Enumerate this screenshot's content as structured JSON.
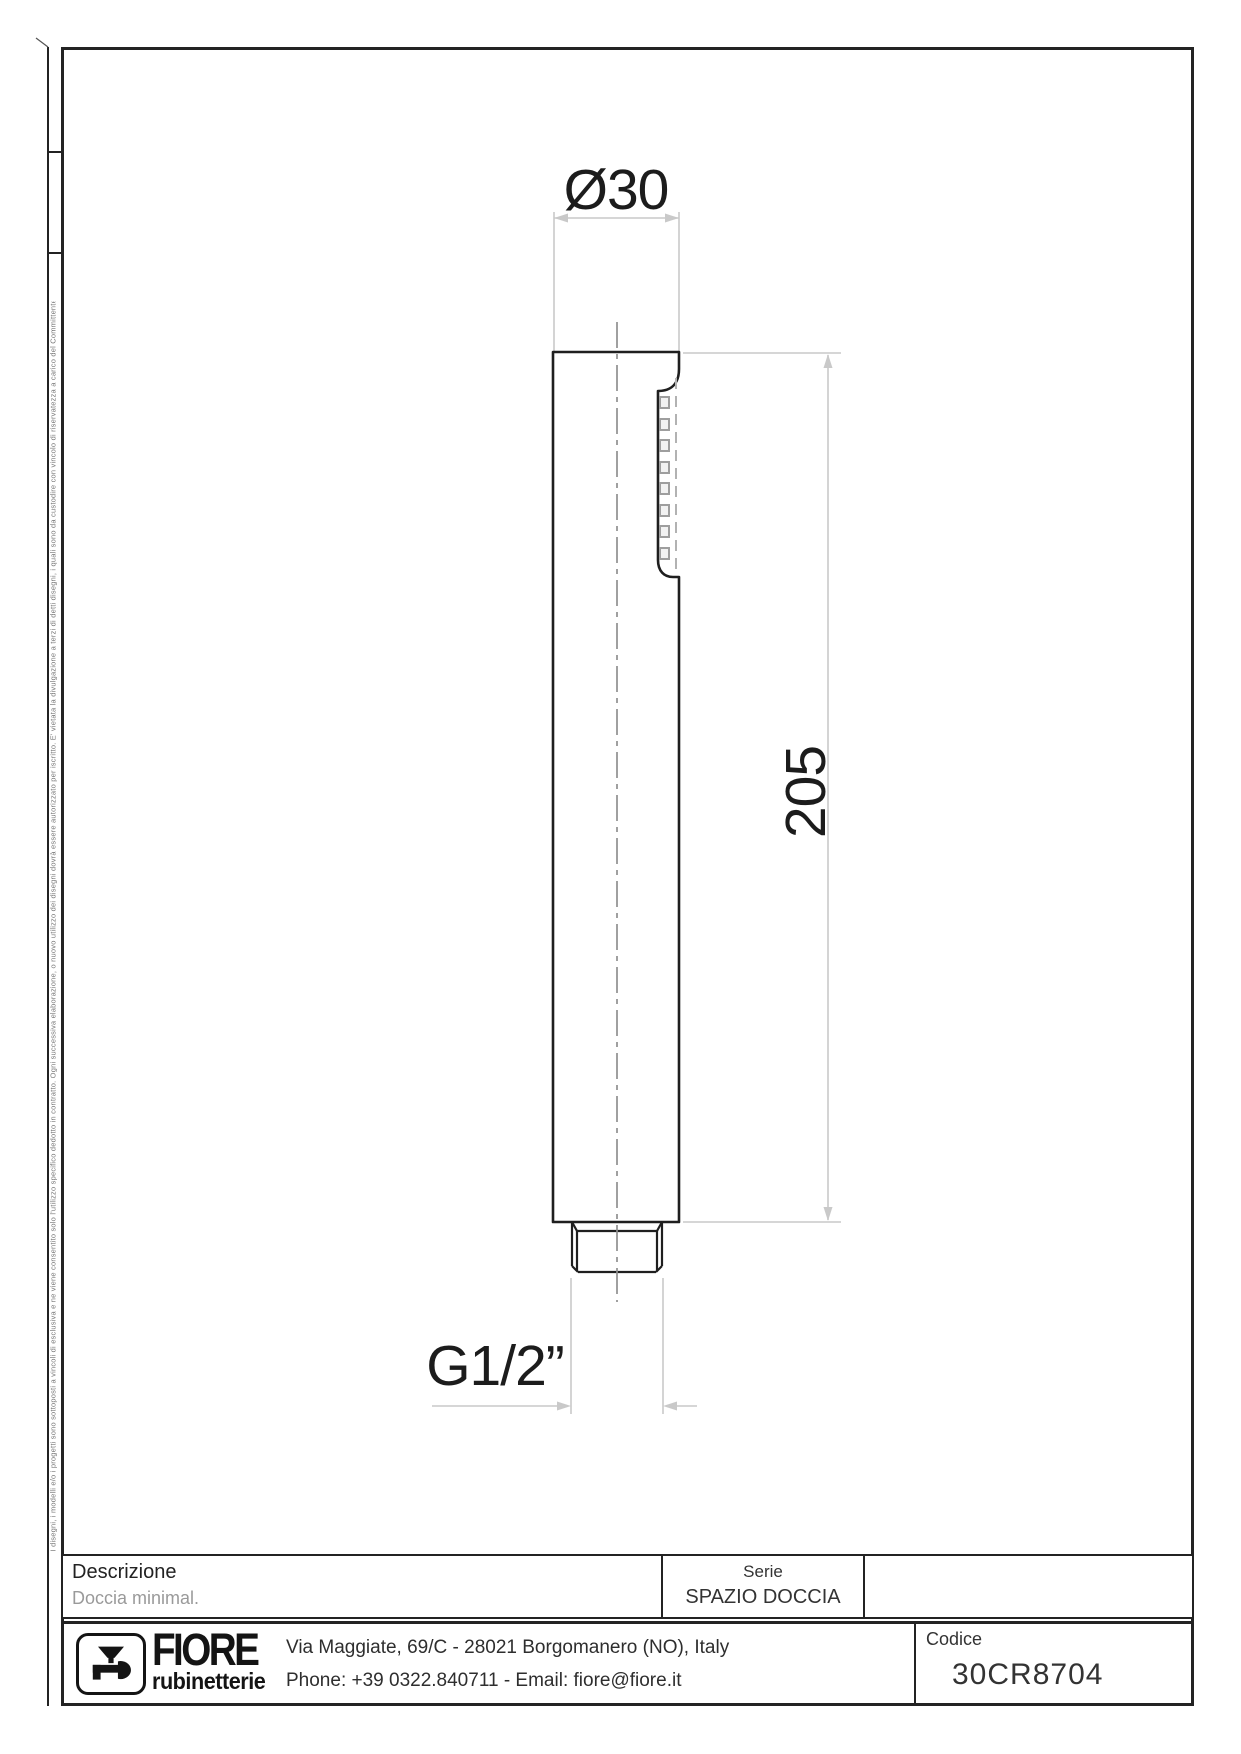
{
  "drawing": {
    "dim_diameter": "Ø30",
    "dim_height": "205",
    "dim_thread": "G1/2”"
  },
  "title_block": {
    "description_label": "Descrizione",
    "description_value": "Doccia minimal.",
    "series_label": "Serie",
    "series_value": "SPAZIO DOCCIA",
    "code_label": "Codice",
    "code_value": "30CR8704",
    "brand_name": "FIORE",
    "brand_subtitle": "rubinetterie",
    "address_line1": "Via Maggiate, 69/C - 28021 Borgomanero (NO), Italy",
    "address_line2": "Phone: +39 0322.840711 - Email: fiore@fiore.it"
  },
  "side_note": "I disegni, i modelli e/o i progetti sono sottoposti a vincoli di esclusiva e ne viene consentito solo l'utilizzo specifico dedotto in contratto. Ogni successiva elaborazione, o nuovo utilizzo dei disegni dovrà essere autorizzato per iscritto. E' vietata la divulgazione a terzi di detti disegni, i quali sono da custodire con vincolo di riservatezza a carico del Committente/Cliente. Ogni utilizzo di detti disegni oltre i limiti negoziali pattuiti e convenuti sarà perseguito a termini di legge.",
  "colors": {
    "line": "#1f1f1f",
    "dimension": "#c9c9c9",
    "centerline": "#8f8f8f",
    "muted_text": "#9a9a9a"
  }
}
